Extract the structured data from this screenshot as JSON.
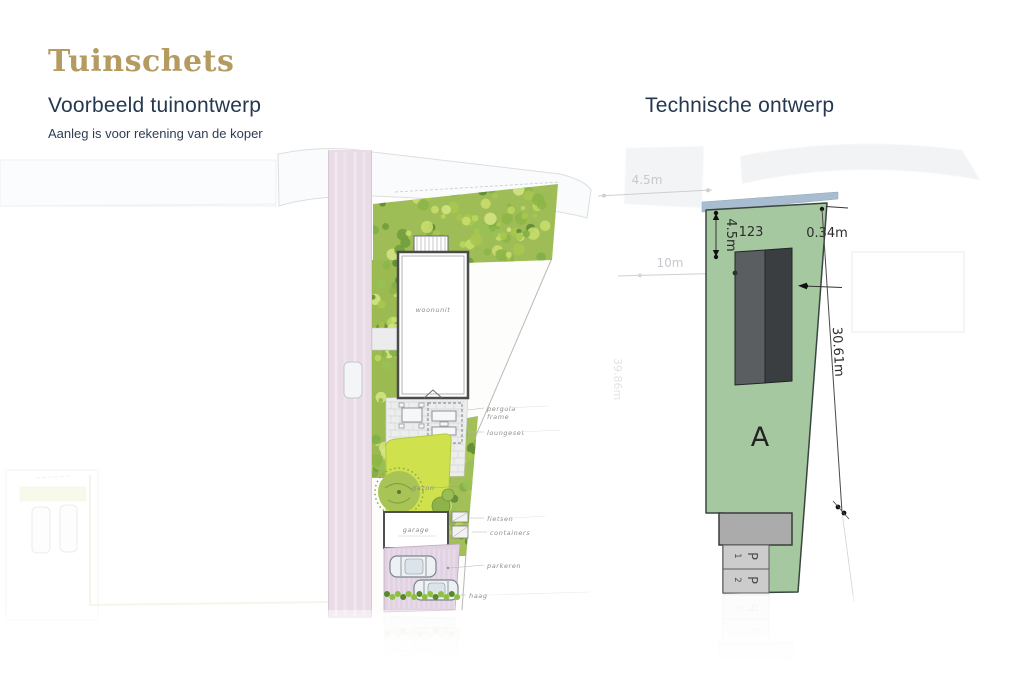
{
  "header": {
    "title": "Tuinschets"
  },
  "left_panel": {
    "heading": "Voorbeeld tuinontwerp",
    "subheading": "Aanleg is voor rekening van de koper",
    "labels": {
      "house": "woonunit",
      "lawn": "gazon",
      "garage": "garage",
      "pergola_line1": "pergola",
      "pergola_line2": "frame",
      "lounge": "loungeset",
      "bikes": "fietsen",
      "containers": "containers",
      "driveway": "parkeren",
      "hedge": "haag"
    }
  },
  "right_panel": {
    "heading": "Technische ontwerp",
    "plot": {
      "number": "123",
      "zone": "A",
      "parking": [
        {
          "letter": "P",
          "number": "1"
        },
        {
          "letter": "P",
          "number": "2"
        }
      ]
    },
    "dimensions": {
      "setback": "4.5m",
      "side_offset": "0.34m",
      "length": "30.61m",
      "faded_road_width": "4.5m",
      "faded_depth": "10m",
      "faded_side_length": "39.86m"
    }
  },
  "colors": {
    "title_gold": "#b49b60",
    "heading_navy": "#263750",
    "plot_green": "#a6c8a1",
    "road_blue": "#a9bdd1",
    "building_dark": "#3a3e40",
    "building_mid": "#5a5e60",
    "lawn_green": "#cfe24e",
    "driveway_pink": "#e0d2e1"
  }
}
